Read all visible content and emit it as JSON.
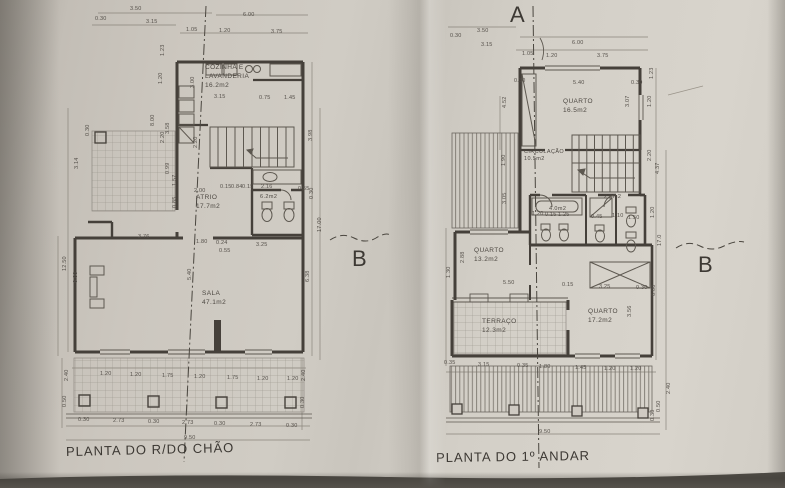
{
  "colors": {
    "paper": "#d0ccc4",
    "ink": "#45403a",
    "thin_line": "#5d5850",
    "dim_line": "#8a857c"
  },
  "plans": [
    {
      "caption": "PLANTA DO R/DO CHÃO",
      "rooms": [
        {
          "lines": [
            "COZINHA E",
            "LAVANDERIA",
            "16.2m2"
          ],
          "x": 205,
          "y": 64
        },
        {
          "lines": [
            "ATRIO",
            "17.7m2"
          ],
          "x": 196,
          "y": 194
        },
        {
          "lines": [
            "6.2m2"
          ],
          "x": 260,
          "y": 194,
          "small": true
        },
        {
          "lines": [
            "SALA",
            "47.1m2"
          ],
          "x": 202,
          "y": 290
        }
      ],
      "markers": [
        {
          "t": "B",
          "x": 352,
          "y": 246
        }
      ],
      "dims": [
        {
          "t": "3.50",
          "x": 130,
          "y": 6
        },
        {
          "t": "0.30",
          "x": 95,
          "y": 16
        },
        {
          "t": "3.15",
          "x": 146,
          "y": 19
        },
        {
          "t": "6.00",
          "x": 243,
          "y": 12
        },
        {
          "t": "1.05",
          "x": 186,
          "y": 27
        },
        {
          "t": "1.20",
          "x": 219,
          "y": 28
        },
        {
          "t": "3.75",
          "x": 271,
          "y": 29
        },
        {
          "t": "1.23",
          "x": 160,
          "y": 50,
          "v": true
        },
        {
          "t": "1.20",
          "x": 158,
          "y": 78,
          "v": true
        },
        {
          "t": "3.00",
          "x": 190,
          "y": 82,
          "v": true
        },
        {
          "t": "3.15",
          "x": 214,
          "y": 94
        },
        {
          "t": "0.75",
          "x": 259,
          "y": 95
        },
        {
          "t": "1.45",
          "x": 284,
          "y": 95
        },
        {
          "t": "8.00",
          "x": 150,
          "y": 120,
          "v": true
        },
        {
          "t": "3.58",
          "x": 165,
          "y": 128,
          "v": true
        },
        {
          "t": "2.20",
          "x": 160,
          "y": 137,
          "v": true
        },
        {
          "t": "0.30",
          "x": 85,
          "y": 130,
          "v": true
        },
        {
          "t": "3.14",
          "x": 74,
          "y": 163,
          "v": true
        },
        {
          "t": "2.20",
          "x": 193,
          "y": 142,
          "v": true
        },
        {
          "t": "3.98",
          "x": 308,
          "y": 135,
          "v": true
        },
        {
          "t": "0.99",
          "x": 165,
          "y": 168,
          "v": true
        },
        {
          "t": "1.57",
          "x": 172,
          "y": 180,
          "v": true
        },
        {
          "t": "0.85",
          "x": 172,
          "y": 202,
          "v": true
        },
        {
          "t": "2.00",
          "x": 194,
          "y": 188
        },
        {
          "t": "0.15",
          "x": 220,
          "y": 184
        },
        {
          "t": "0.84",
          "x": 231,
          "y": 184
        },
        {
          "t": "0.15",
          "x": 242,
          "y": 184
        },
        {
          "t": "2.16",
          "x": 261,
          "y": 184
        },
        {
          "t": "0.55",
          "x": 298,
          "y": 186
        },
        {
          "t": "3.76",
          "x": 138,
          "y": 234
        },
        {
          "t": "1.80",
          "x": 196,
          "y": 239
        },
        {
          "t": "0.24",
          "x": 216,
          "y": 240
        },
        {
          "t": "3.25",
          "x": 256,
          "y": 242
        },
        {
          "t": "0.55",
          "x": 219,
          "y": 248
        },
        {
          "t": "5.40",
          "x": 187,
          "y": 274,
          "v": true
        },
        {
          "t": "6.38",
          "x": 305,
          "y": 276,
          "v": true
        },
        {
          "t": "12.50",
          "x": 62,
          "y": 265,
          "v": true
        },
        {
          "t": "6.00",
          "x": 73,
          "y": 277,
          "v": true
        },
        {
          "t": "0.30",
          "x": 309,
          "y": 193,
          "v": true
        },
        {
          "t": "17.00",
          "x": 317,
          "y": 226,
          "v": true
        },
        {
          "t": "1.20",
          "x": 100,
          "y": 371
        },
        {
          "t": "1.20",
          "x": 130,
          "y": 372
        },
        {
          "t": "1.75",
          "x": 162,
          "y": 373
        },
        {
          "t": "1.20",
          "x": 194,
          "y": 374
        },
        {
          "t": "1.75",
          "x": 227,
          "y": 375
        },
        {
          "t": "1.20",
          "x": 257,
          "y": 376
        },
        {
          "t": "1.20",
          "x": 287,
          "y": 376
        },
        {
          "t": "2.40",
          "x": 64,
          "y": 375,
          "v": true
        },
        {
          "t": "0.50",
          "x": 62,
          "y": 401,
          "v": true
        },
        {
          "t": "2.40",
          "x": 301,
          "y": 375,
          "v": true
        },
        {
          "t": "0.30",
          "x": 300,
          "y": 402,
          "v": true
        },
        {
          "t": "0.30",
          "x": 78,
          "y": 417
        },
        {
          "t": "2.73",
          "x": 113,
          "y": 418
        },
        {
          "t": "0.30",
          "x": 148,
          "y": 419
        },
        {
          "t": "2.73",
          "x": 182,
          "y": 420
        },
        {
          "t": "0.30",
          "x": 214,
          "y": 421
        },
        {
          "t": "2.73",
          "x": 250,
          "y": 422
        },
        {
          "t": "0.30",
          "x": 286,
          "y": 423
        },
        {
          "t": "9.50",
          "x": 184,
          "y": 435
        }
      ]
    },
    {
      "caption": "PLANTA DO 1º ANDAR",
      "rooms": [
        {
          "lines": [
            "QUARTO",
            "16.5m2"
          ],
          "x": 563,
          "y": 98
        },
        {
          "lines": [
            "CIRCULAÇÃO",
            "10.5m2"
          ],
          "x": 524,
          "y": 149,
          "small": true
        },
        {
          "lines": [
            "4.0m2"
          ],
          "x": 549,
          "y": 206,
          "small": true
        },
        {
          "lines": [
            "2.5m2"
          ],
          "x": 604,
          "y": 194,
          "small": true
        },
        {
          "lines": [
            "QUARTO",
            "13.2m2"
          ],
          "x": 474,
          "y": 247
        },
        {
          "lines": [
            "TERRAÇO",
            "12.3m2"
          ],
          "x": 482,
          "y": 318
        },
        {
          "lines": [
            "QUARTO",
            "17.2m2"
          ],
          "x": 588,
          "y": 308
        }
      ],
      "markers": [
        {
          "t": "A",
          "x": 510,
          "y": 2
        },
        {
          "t": "B",
          "x": 698,
          "y": 252
        }
      ],
      "dims": [
        {
          "t": "3.50",
          "x": 477,
          "y": 28
        },
        {
          "t": "0.30",
          "x": 450,
          "y": 33
        },
        {
          "t": "3.15",
          "x": 481,
          "y": 42
        },
        {
          "t": "6.00",
          "x": 572,
          "y": 40
        },
        {
          "t": "1.05",
          "x": 522,
          "y": 51
        },
        {
          "t": "1.20",
          "x": 546,
          "y": 53
        },
        {
          "t": "3.75",
          "x": 597,
          "y": 53
        },
        {
          "t": "0.30",
          "x": 514,
          "y": 78
        },
        {
          "t": "5.40",
          "x": 573,
          "y": 80
        },
        {
          "t": "0.30",
          "x": 631,
          "y": 80
        },
        {
          "t": "1.23",
          "x": 649,
          "y": 73,
          "v": true
        },
        {
          "t": "1.20",
          "x": 647,
          "y": 101,
          "v": true
        },
        {
          "t": "3.07",
          "x": 625,
          "y": 101,
          "v": true
        },
        {
          "t": "4.52",
          "x": 502,
          "y": 102,
          "v": true
        },
        {
          "t": "2.20",
          "x": 647,
          "y": 155,
          "v": true
        },
        {
          "t": "4.37",
          "x": 655,
          "y": 168,
          "v": true
        },
        {
          "t": "1.20",
          "x": 650,
          "y": 212,
          "v": true
        },
        {
          "t": "1.20",
          "x": 532,
          "y": 211
        },
        {
          "t": "0.15",
          "x": 545,
          "y": 212
        },
        {
          "t": "1.25",
          "x": 558,
          "y": 212
        },
        {
          "t": "0.45",
          "x": 591,
          "y": 214
        },
        {
          "t": "1.10",
          "x": 612,
          "y": 213
        },
        {
          "t": "1.50",
          "x": 628,
          "y": 215
        },
        {
          "t": "1.90",
          "x": 501,
          "y": 160,
          "v": true
        },
        {
          "t": "3.05",
          "x": 502,
          "y": 198,
          "v": true
        },
        {
          "t": "2.88",
          "x": 460,
          "y": 257,
          "v": true
        },
        {
          "t": "1.30",
          "x": 446,
          "y": 272,
          "v": true
        },
        {
          "t": "5.50",
          "x": 503,
          "y": 280
        },
        {
          "t": "0.15",
          "x": 562,
          "y": 282
        },
        {
          "t": "3.25",
          "x": 599,
          "y": 284
        },
        {
          "t": "0.30",
          "x": 636,
          "y": 285
        },
        {
          "t": "6.00",
          "x": 651,
          "y": 290,
          "v": true
        },
        {
          "t": "3.56",
          "x": 627,
          "y": 311,
          "v": true
        },
        {
          "t": "17.0",
          "x": 657,
          "y": 240,
          "v": true
        },
        {
          "t": "0.35",
          "x": 444,
          "y": 360
        },
        {
          "t": "3.15",
          "x": 478,
          "y": 362
        },
        {
          "t": "0.35",
          "x": 517,
          "y": 363
        },
        {
          "t": "1.80",
          "x": 539,
          "y": 364
        },
        {
          "t": "1.45",
          "x": 575,
          "y": 365
        },
        {
          "t": "1.20",
          "x": 604,
          "y": 366
        },
        {
          "t": "1.20",
          "x": 630,
          "y": 366
        },
        {
          "t": "9.50",
          "x": 539,
          "y": 429
        },
        {
          "t": "2.40",
          "x": 666,
          "y": 388,
          "v": true
        },
        {
          "t": "0.50",
          "x": 656,
          "y": 406,
          "v": true
        },
        {
          "t": "0.30",
          "x": 650,
          "y": 415,
          "v": true
        }
      ]
    }
  ]
}
